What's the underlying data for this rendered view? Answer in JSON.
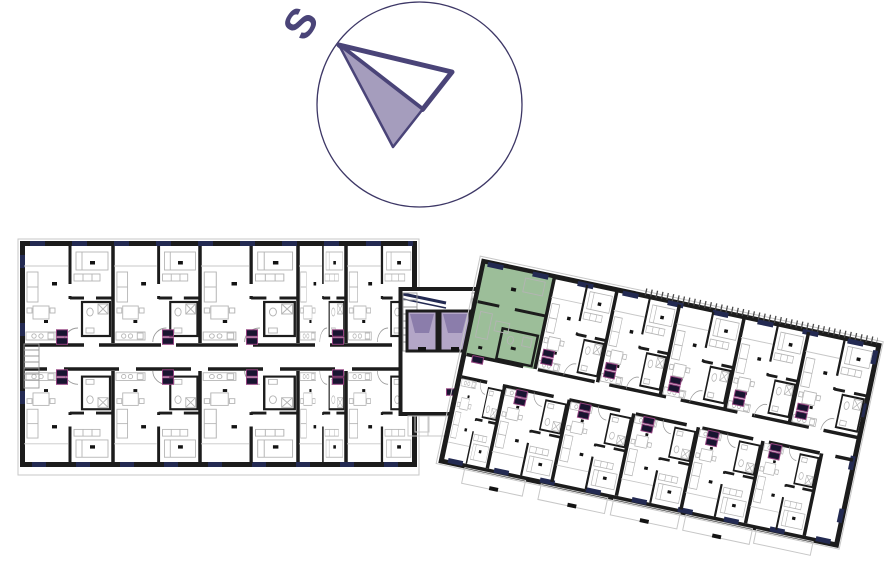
{
  "compass": {
    "label": "S",
    "description": "compass rose, needle pointing to upper-left toward S"
  },
  "floorplan": {
    "highlighted_unit": {
      "wing": "right-wing",
      "position": "left end, top side",
      "fill": "#9cbe99"
    },
    "wings": [
      {
        "id": "left-wing",
        "rotation_deg": 0,
        "units_top": 5,
        "units_bottom": 5
      },
      {
        "id": "right-wing",
        "rotation_deg": 12,
        "units_top": 5,
        "units_bottom": 6
      }
    ],
    "core": {
      "elevators": 2,
      "stairwell": true
    }
  },
  "colors": {
    "wall": "#1c1c1c",
    "furn": "#b4b4b4",
    "window": "#232a52",
    "highlight": "#9cbe99",
    "elevator": "#b3a6c7",
    "elevatorDark": "#8b7dab",
    "tag": "#181430",
    "tagBorder": "#93407f",
    "compassStroke": "#4a4478",
    "compassFill": "#a59dbd",
    "circleStroke": "#3d3766",
    "hatch": "#4a4a4a"
  }
}
